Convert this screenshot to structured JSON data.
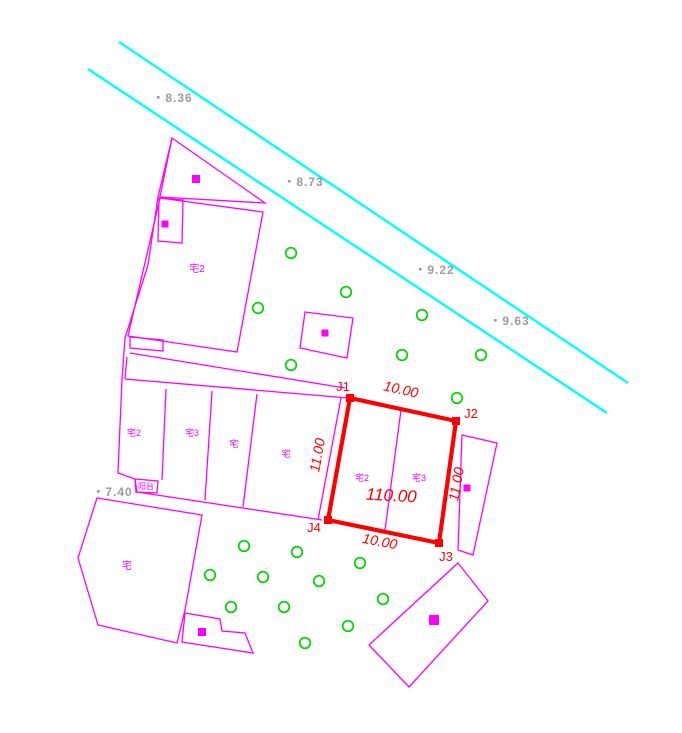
{
  "canvas": {
    "width": 682,
    "height": 733,
    "background": "#ffffff"
  },
  "colors": {
    "magenta": "#ff00ff",
    "red": "#ff0000",
    "cyan": "#00ffff",
    "green": "#00d400",
    "gray": "#9b9b9b"
  },
  "road_lines": [
    {
      "name": "road-edge-upper",
      "points": [
        [
          119,
          42
        ],
        [
          628,
          383
        ]
      ]
    },
    {
      "name": "road-edge-lower",
      "points": [
        [
          88,
          69
        ],
        [
          607,
          413
        ]
      ]
    }
  ],
  "elevation_points": [
    {
      "label": "8.36",
      "x": 157,
      "y": 96
    },
    {
      "label": "8.73",
      "x": 288,
      "y": 180
    },
    {
      "label": "9.22",
      "x": 419,
      "y": 268
    },
    {
      "label": "9.63",
      "x": 494,
      "y": 319
    },
    {
      "label": "7.40",
      "x": 97,
      "y": 490
    }
  ],
  "trees": [
    [
      291,
      253
    ],
    [
      346,
      292
    ],
    [
      258,
      308
    ],
    [
      422,
      315
    ],
    [
      402,
      355
    ],
    [
      291,
      365
    ],
    [
      481,
      355
    ],
    [
      457,
      398
    ],
    [
      244,
      546
    ],
    [
      297,
      552
    ],
    [
      210,
      575
    ],
    [
      263,
      577
    ],
    [
      360,
      563
    ],
    [
      319,
      581
    ],
    [
      231,
      607
    ],
    [
      284,
      607
    ],
    [
      383,
      599
    ],
    [
      348,
      626
    ],
    [
      305,
      643
    ]
  ],
  "buildings": [
    {
      "name": "triangle-building",
      "closed": true,
      "points": [
        [
          172,
          138
        ],
        [
          265,
          203
        ],
        [
          160,
          197
        ]
      ]
    },
    {
      "name": "upper-parcel",
      "closed": true,
      "points": [
        [
          160,
          198
        ],
        [
          263,
          212
        ],
        [
          237,
          352
        ],
        [
          128,
          336
        ]
      ]
    },
    {
      "name": "upper-parcel-annex",
      "closed": true,
      "points": [
        [
          159,
          198
        ],
        [
          183,
          200
        ],
        [
          182,
          243
        ],
        [
          158,
          241
        ]
      ]
    },
    {
      "name": "upper-parcel-notch",
      "closed": true,
      "points": [
        [
          130,
          337
        ],
        [
          163,
          340
        ],
        [
          163,
          351
        ],
        [
          130,
          348
        ]
      ]
    },
    {
      "name": "west-boundary",
      "closed": false,
      "points": [
        [
          172,
          138
        ],
        [
          158,
          197
        ],
        [
          148,
          265
        ],
        [
          125,
          338
        ],
        [
          122,
          379
        ],
        [
          118,
          473
        ],
        [
          135,
          479
        ],
        [
          137,
          492
        ]
      ]
    },
    {
      "name": "lane-line",
      "closed": false,
      "points": [
        [
          130,
          353
        ],
        [
          345,
          388
        ]
      ]
    },
    {
      "name": "lane-connector",
      "closed": false,
      "points": [
        [
          127,
          357
        ],
        [
          125,
          379
        ]
      ]
    },
    {
      "name": "middle-block-top",
      "closed": false,
      "points": [
        [
          125,
          379
        ],
        [
          348,
          398
        ]
      ]
    },
    {
      "name": "middle-block-bottom",
      "closed": false,
      "points": [
        [
          137,
          492
        ],
        [
          322,
          520
        ]
      ]
    },
    {
      "name": "middle-block-divider-1",
      "closed": false,
      "points": [
        [
          166,
          389
        ],
        [
          162,
          480
        ]
      ]
    },
    {
      "name": "middle-block-divider-2",
      "closed": false,
      "points": [
        [
          212,
          391
        ],
        [
          205,
          500
        ]
      ]
    },
    {
      "name": "middle-block-divider-3",
      "closed": false,
      "points": [
        [
          257,
          394
        ],
        [
          243,
          507
        ]
      ]
    },
    {
      "name": "middle-block-divider-4",
      "closed": false,
      "points": [
        [
          341,
          398
        ],
        [
          318,
          520
        ]
      ]
    },
    {
      "name": "balcony-rect",
      "closed": true,
      "points": [
        [
          135,
          479
        ],
        [
          158,
          481
        ],
        [
          157,
          493
        ],
        [
          136,
          492
        ]
      ]
    },
    {
      "name": "south-parcel",
      "closed": true,
      "points": [
        [
          97,
          498
        ],
        [
          202,
          515
        ],
        [
          185,
          610
        ],
        [
          177,
          643
        ],
        [
          98,
          625
        ],
        [
          78,
          558
        ]
      ]
    },
    {
      "name": "small-south-building",
      "closed": true,
      "points": [
        [
          185,
          613
        ],
        [
          220,
          619
        ],
        [
          222,
          631
        ],
        [
          245,
          633
        ],
        [
          253,
          653
        ],
        [
          182,
          642
        ]
      ]
    },
    {
      "name": "southeast-building",
      "closed": true,
      "points": [
        [
          458,
          563
        ],
        [
          488,
          601
        ],
        [
          409,
          687
        ],
        [
          369,
          645
        ]
      ]
    },
    {
      "name": "east-building",
      "closed": true,
      "points": [
        [
          462,
          435
        ],
        [
          497,
          443
        ],
        [
          473,
          555
        ],
        [
          458,
          550
        ]
      ]
    },
    {
      "name": "center-square-building",
      "closed": true,
      "points": [
        [
          305,
          312
        ],
        [
          353,
          318
        ],
        [
          347,
          358
        ],
        [
          300,
          348
        ]
      ]
    }
  ],
  "building_markers": [
    [
      196,
      179,
      8
    ],
    [
      165,
      224,
      7
    ],
    [
      325,
      333,
      7
    ],
    [
      467,
      488,
      7
    ],
    [
      434,
      620,
      10
    ],
    [
      202,
      632,
      8
    ]
  ],
  "building_labels": [
    {
      "text": "宅2",
      "x": 197,
      "y": 272,
      "size": 10
    },
    {
      "text": "宅2",
      "x": 134,
      "y": 436,
      "size": 9
    },
    {
      "text": "宅3",
      "x": 192,
      "y": 436,
      "size": 9
    },
    {
      "text": "宅",
      "x": 234,
      "y": 447,
      "size": 9
    },
    {
      "text": "宅",
      "x": 286,
      "y": 457,
      "size": 9
    },
    {
      "text": "阳台",
      "x": 146,
      "y": 489,
      "size": 8
    },
    {
      "text": "宅",
      "x": 127,
      "y": 569,
      "size": 10
    }
  ],
  "parcel": {
    "corners": [
      {
        "name": "J1",
        "x": 350,
        "y": 398,
        "label_x": 343,
        "label_y": 391
      },
      {
        "name": "J2",
        "x": 456,
        "y": 421,
        "label_x": 471,
        "label_y": 418
      },
      {
        "name": "J3",
        "x": 439,
        "y": 543,
        "label_x": 446,
        "label_y": 561
      },
      {
        "name": "J4",
        "x": 328,
        "y": 520,
        "label_x": 314,
        "label_y": 532
      }
    ],
    "divider": [
      [
        401,
        410
      ],
      [
        385,
        530
      ]
    ],
    "dims": [
      {
        "text": "10.00",
        "x": 400,
        "y": 394,
        "rot": 12.5
      },
      {
        "text": "10.00",
        "x": 379,
        "y": 546,
        "rot": 11
      },
      {
        "text": "11.00",
        "x": 322,
        "y": 456,
        "rot": -80
      },
      {
        "text": "11.00",
        "x": 461,
        "y": 485,
        "rot": -80
      }
    ],
    "area": {
      "text": "110.00",
      "x": 391,
      "y": 501,
      "rot": 3
    },
    "inner_labels": [
      {
        "text": "宅2",
        "x": 362,
        "y": 481,
        "size": 9
      },
      {
        "text": "宅3",
        "x": 419,
        "y": 481,
        "size": 9
      }
    ]
  }
}
